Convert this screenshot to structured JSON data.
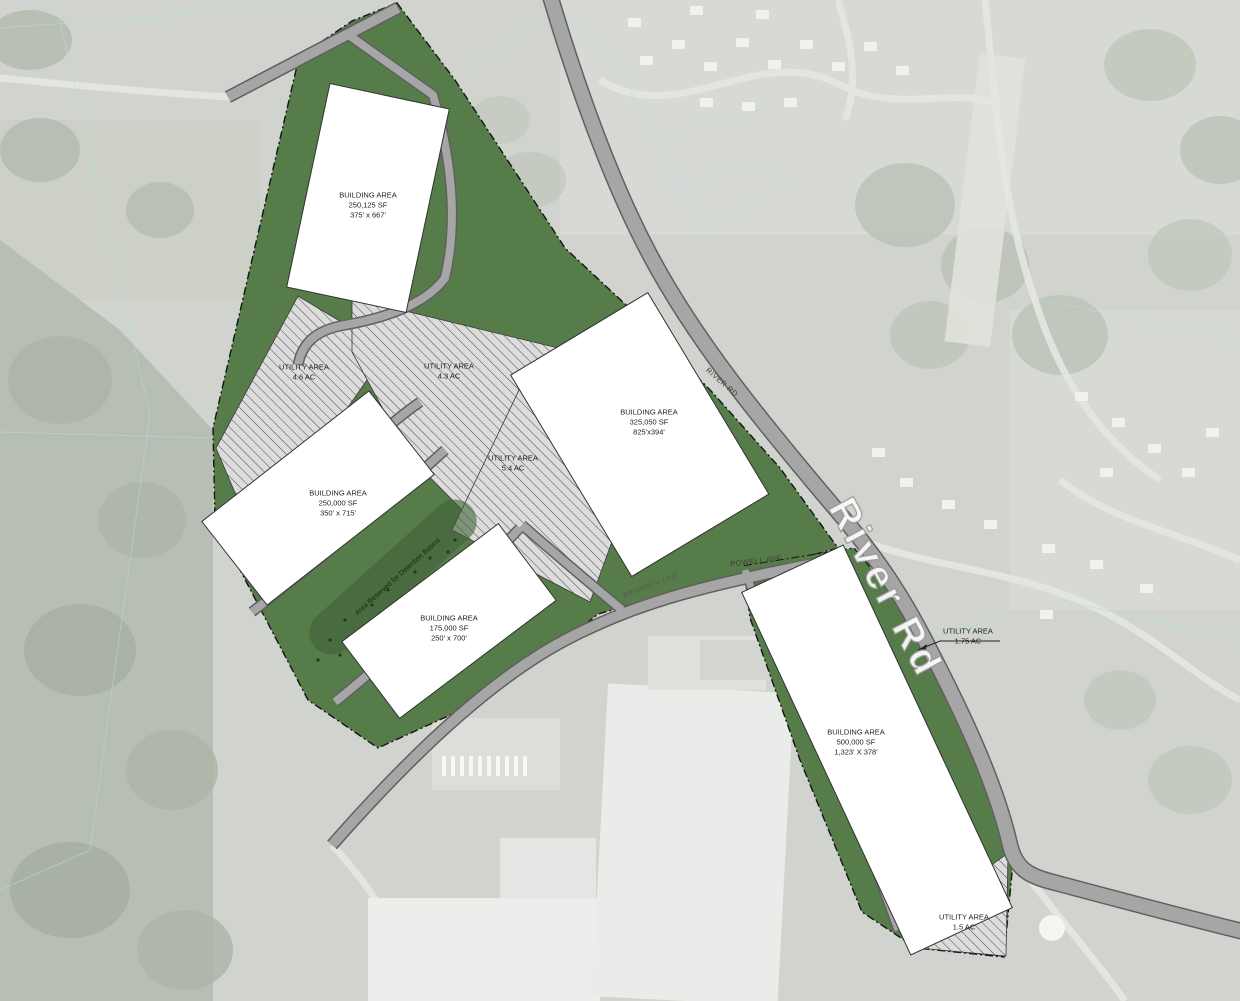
{
  "plan": {
    "buildings": [
      {
        "lines": [
          "BUILDING AREA",
          "250,125 SF",
          "375' x 667'"
        ]
      },
      {
        "lines": [
          "BUILDING AREA",
          "250,000 SF",
          "350' x 715'"
        ]
      },
      {
        "lines": [
          "BUILDING AREA",
          "175,000 SF",
          "250' x 700'"
        ]
      },
      {
        "lines": [
          "BUILDING AREA",
          "325,050 SF",
          "825'x394'"
        ]
      },
      {
        "lines": [
          "BUILDING AREA",
          "500,000 SF",
          "1,323' X 378'"
        ]
      }
    ],
    "utility_areas": [
      {
        "lines": [
          "UTILITY AREA",
          "4.6 AC"
        ]
      },
      {
        "lines": [
          "UTILITY AREA",
          "4.3 AC"
        ]
      },
      {
        "lines": [
          "UTILITY AREA",
          "5.4 AC"
        ]
      },
      {
        "lines": [
          "UTILITY AREA",
          "1.75 AC"
        ]
      },
      {
        "lines": [
          "UTILITY AREA",
          "1.5 AC"
        ]
      }
    ],
    "road_labels": {
      "river_rd_large": "River Rd",
      "river_rd_small": "RIVER RD",
      "powell_ave": "POWELL AVE",
      "property_line": "PROPERTY LINE"
    },
    "annotations": {
      "detention_note": "Area Reserved for Detention Basins"
    },
    "colors": {
      "site_green": "#567c4a",
      "detention_green": "#3f6239",
      "road_gray": "#a6a6a6",
      "road_casing": "#606060",
      "hatch_background": "#dcdcdc",
      "hatch_line": "#4a4a4a",
      "building_white": "#ffffff",
      "boundary_black": "#141414",
      "parcel_line_cyan": "#7ed2d6"
    }
  }
}
